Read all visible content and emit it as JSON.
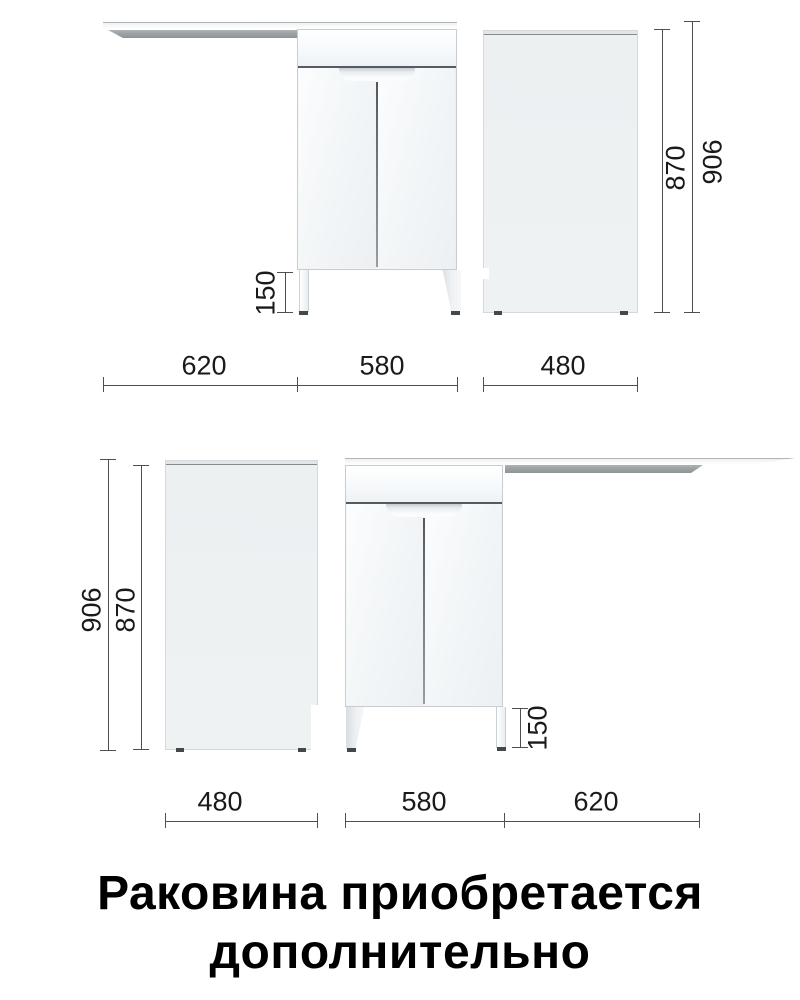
{
  "views": {
    "top": {
      "width_labels": [
        "620",
        "580",
        "480"
      ],
      "leg_height_label": "150",
      "cabinet_height_label": "870",
      "total_height_label": "906"
    },
    "bottom": {
      "width_labels": [
        "480",
        "580",
        "620"
      ],
      "leg_height_label": "150",
      "cabinet_height_label": "870",
      "total_height_label": "906"
    }
  },
  "caption": {
    "line1": "Раковина приобретается",
    "line2": "дополнительно"
  },
  "colors": {
    "background": "#ffffff",
    "dimension_lines": "#4f4f4f",
    "dimension_text": "#1a1a1a",
    "cabinet_fill": "#f6f9fb",
    "side_panel_fill": "#eef1f2",
    "countertop_underside": "#9da2a4",
    "dark_accent": "#43484b",
    "caption_text": "#000000"
  }
}
